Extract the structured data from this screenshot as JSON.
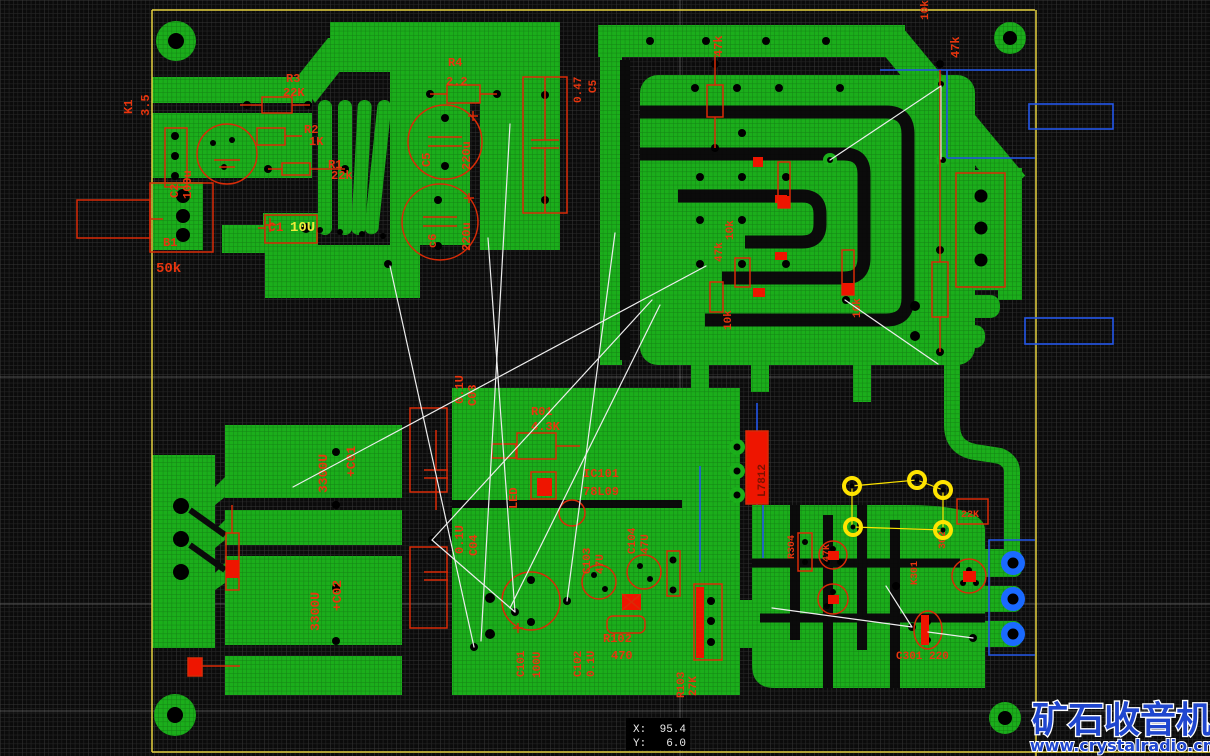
{
  "app": {
    "type": "pcb-layout-editor-canvas"
  },
  "colors": {
    "background": "#0b0b0b",
    "grid_minor": "#343434",
    "grid_major": "#4a4a4a",
    "copper": "#1bae1b",
    "silkscreen": "#e8350e",
    "silkscreen_fill": "#ee1500",
    "board_outline": "#e6d23f",
    "ratsnest": "#ededed",
    "keepout_blue": "#2356e8",
    "pad_blue": "#1a6aff",
    "selected_yellow": "#ffe400",
    "value_highlight_yellow": "#f0ea3a",
    "watermark_blue": "#1f46cf"
  },
  "status": {
    "x_label": "X:",
    "x_value": "95.4",
    "y_label": "Y:",
    "y_value": "6.0"
  },
  "watermark": {
    "title": "矿石收音机",
    "url": "www.crystalradio.cn"
  },
  "labels": [
    {
      "t": "K1",
      "x": 132,
      "y": 114,
      "r": -90
    },
    {
      "t": "3.5",
      "x": 149,
      "y": 116,
      "r": -90
    },
    {
      "t": "R3",
      "x": 286,
      "y": 82
    },
    {
      "t": "22K",
      "x": 283,
      "y": 96
    },
    {
      "t": "R2",
      "x": 304,
      "y": 133
    },
    {
      "t": "1K",
      "x": 309,
      "y": 145
    },
    {
      "t": "R1",
      "x": 328,
      "y": 168
    },
    {
      "t": "22k",
      "x": 331,
      "y": 179
    },
    {
      "t": "C2",
      "x": 178,
      "y": 198,
      "r": -90
    },
    {
      "t": "100u",
      "x": 191,
      "y": 199,
      "r": -90
    },
    {
      "t": "B1",
      "x": 163,
      "y": 246
    },
    {
      "t": "50k",
      "x": 156,
      "y": 272,
      "s": 14
    },
    {
      "t": "C1",
      "x": 268,
      "y": 231,
      "s": 13
    },
    {
      "t": "10U",
      "x": 290,
      "y": 231,
      "s": 14,
      "c": "#f0ea3a"
    },
    {
      "t": "R4",
      "x": 448,
      "y": 66
    },
    {
      "t": "2.2",
      "x": 446,
      "y": 85
    },
    {
      "t": "0.47",
      "x": 581,
      "y": 103,
      "r": -90,
      "s": 11
    },
    {
      "t": "C5",
      "x": 596,
      "y": 93,
      "r": -90,
      "s": 11
    },
    {
      "t": "C5",
      "x": 430,
      "y": 167,
      "r": -90
    },
    {
      "t": "220u",
      "x": 470,
      "y": 170,
      "r": -90
    },
    {
      "t": "c6",
      "x": 436,
      "y": 248,
      "r": -90
    },
    {
      "t": "220u",
      "x": 470,
      "y": 251,
      "r": -90
    },
    {
      "t": "47k",
      "x": 722,
      "y": 57,
      "r": -90
    },
    {
      "t": "10k",
      "x": 928,
      "y": 20,
      "r": -90,
      "s": 11
    },
    {
      "t": "47k",
      "x": 959,
      "y": 58,
      "r": -90
    },
    {
      "t": "10k",
      "x": 733,
      "y": 240,
      "r": -90,
      "s": 11
    },
    {
      "t": "47k",
      "x": 722,
      "y": 262,
      "r": -90,
      "s": 11
    },
    {
      "t": "10k",
      "x": 731,
      "y": 330,
      "r": -90,
      "s": 11
    },
    {
      "t": "10k",
      "x": 860,
      "y": 318,
      "r": -90,
      "s": 11
    },
    {
      "t": "3300U",
      "x": 327,
      "y": 493,
      "r": -90,
      "s": 13
    },
    {
      "t": "+C01",
      "x": 355,
      "y": 477,
      "r": -90,
      "s": 13
    },
    {
      "t": "3300U",
      "x": 319,
      "y": 631,
      "r": -90,
      "s": 13
    },
    {
      "t": "+C02",
      "x": 341,
      "y": 611,
      "r": -90,
      "s": 13
    },
    {
      "t": "0.1U",
      "x": 463,
      "y": 404,
      "r": -90
    },
    {
      "t": "C03",
      "x": 476,
      "y": 406,
      "r": -90
    },
    {
      "t": "0.1U",
      "x": 463,
      "y": 554,
      "r": -90
    },
    {
      "t": "C04",
      "x": 477,
      "y": 556,
      "r": -90
    },
    {
      "t": "R01",
      "x": 531,
      "y": 415
    },
    {
      "t": "4.3K",
      "x": 531,
      "y": 430
    },
    {
      "t": "LED",
      "x": 517,
      "y": 509,
      "r": -90
    },
    {
      "t": "IC101",
      "x": 583,
      "y": 477
    },
    {
      "t": "78L09",
      "x": 583,
      "y": 495
    },
    {
      "t": "C103",
      "x": 590,
      "y": 574,
      "r": -90,
      "s": 11
    },
    {
      "t": "47U",
      "x": 603,
      "y": 574,
      "r": -90,
      "s": 11
    },
    {
      "t": "C104",
      "x": 635,
      "y": 554,
      "r": -90,
      "s": 11
    },
    {
      "t": "47U",
      "x": 648,
      "y": 554,
      "r": -90,
      "s": 11
    },
    {
      "t": "C101",
      "x": 524,
      "y": 677,
      "r": -90,
      "s": 11
    },
    {
      "t": "100U",
      "x": 540,
      "y": 678,
      "r": -90,
      "s": 11
    },
    {
      "t": "C102",
      "x": 581,
      "y": 677,
      "r": -90,
      "s": 11
    },
    {
      "t": "0.1U",
      "x": 594,
      "y": 677,
      "r": -90,
      "s": 11
    },
    {
      "t": "R102",
      "x": 603,
      "y": 642
    },
    {
      "t": "470",
      "x": 611,
      "y": 659
    },
    {
      "t": "R103",
      "x": 684,
      "y": 698,
      "r": -90,
      "s": 11
    },
    {
      "t": "27K",
      "x": 696,
      "y": 696,
      "r": -90,
      "s": 11
    },
    {
      "t": "L7812",
      "x": 765,
      "y": 497,
      "r": -90,
      "s": 11,
      "c": "#7a1200"
    },
    {
      "t": "R304",
      "x": 794,
      "y": 559,
      "r": -90,
      "s": 10
    },
    {
      "t": "47K",
      "x": 829,
      "y": 562,
      "r": -90,
      "s": 10
    },
    {
      "t": "K301",
      "x": 917,
      "y": 585,
      "r": -90,
      "s": 10
    },
    {
      "t": "302",
      "x": 945,
      "y": 549,
      "r": -90,
      "s": 10
    },
    {
      "t": "22K",
      "x": 961,
      "y": 517,
      "s": 10
    },
    {
      "t": "C301 220",
      "x": 896,
      "y": 659,
      "s": 11
    }
  ],
  "ratsnest": [
    [
      390,
      266,
      474,
      647
    ],
    [
      510,
      124,
      481,
      641
    ],
    [
      488,
      238,
      515,
      612
    ],
    [
      706,
      266,
      293,
      487
    ],
    [
      615,
      233,
      567,
      601
    ],
    [
      652,
      300,
      432,
      540
    ],
    [
      660,
      305,
      510,
      608
    ],
    [
      830,
      160,
      941,
      86
    ],
    [
      941,
      86,
      941,
      159
    ],
    [
      845,
      300,
      938,
      364
    ],
    [
      772,
      608,
      912,
      627
    ],
    [
      886,
      586,
      912,
      627
    ],
    [
      928,
      632,
      973,
      638
    ],
    [
      432,
      540,
      515,
      612
    ]
  ],
  "selected_net_pads": [
    [
      852,
      486
    ],
    [
      917,
      480
    ],
    [
      943,
      490
    ],
    [
      853,
      527
    ],
    [
      943,
      530
    ]
  ]
}
